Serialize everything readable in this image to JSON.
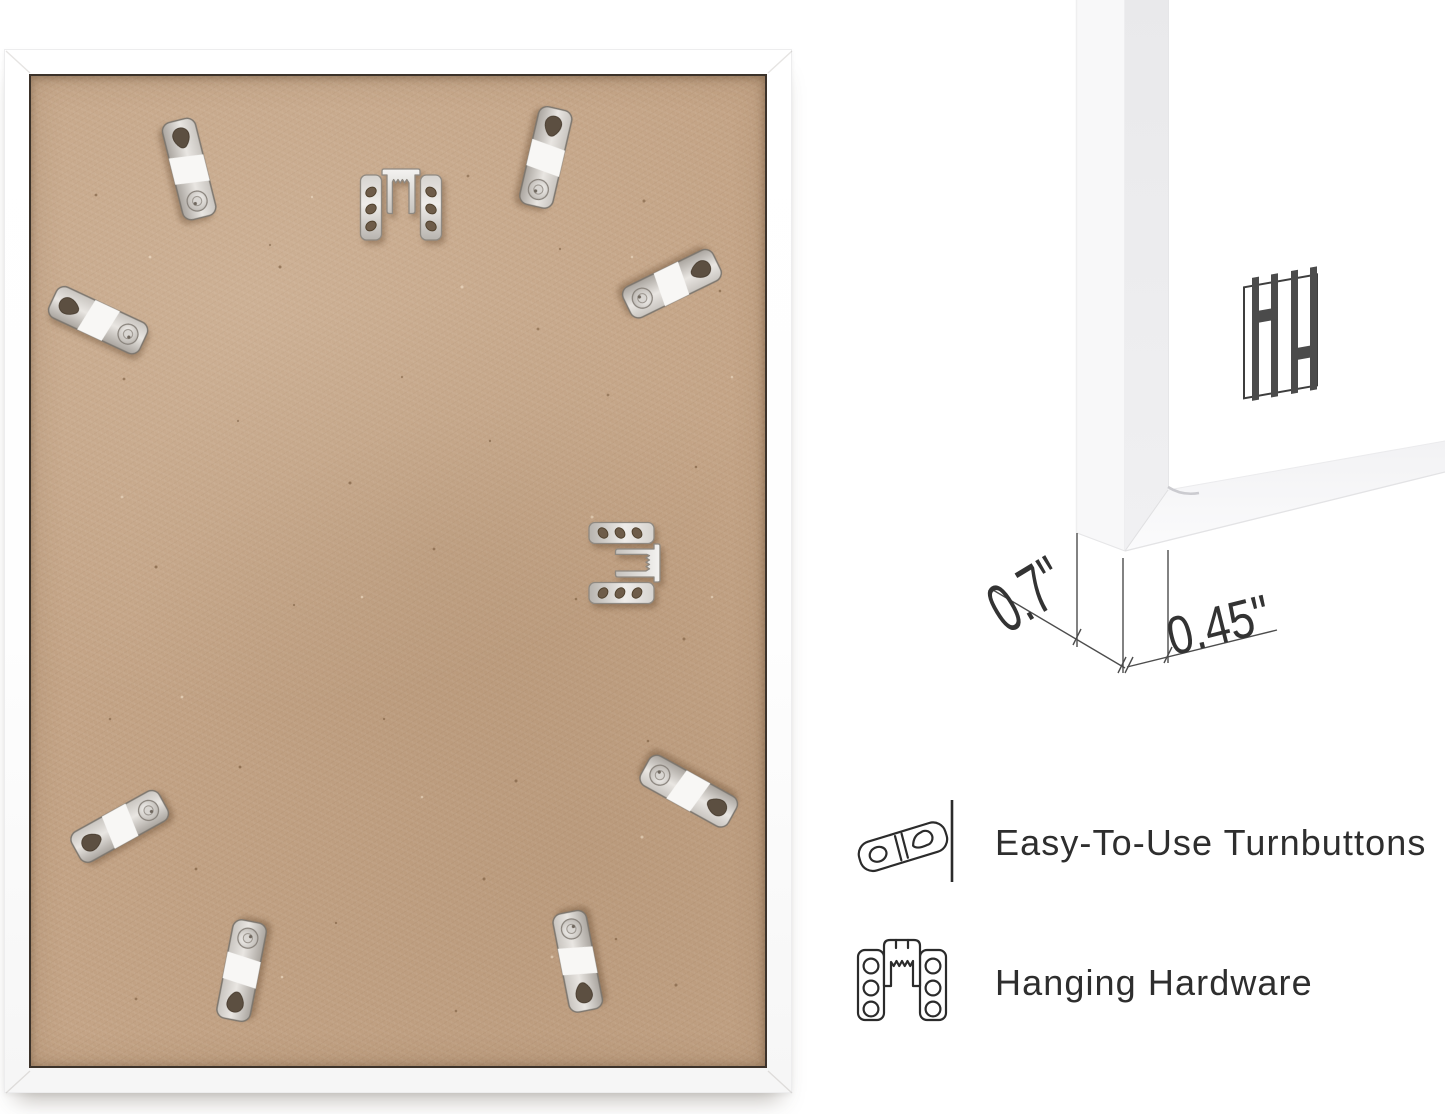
{
  "page": {
    "background": "#ffffff"
  },
  "photo": {
    "subject": "back-of-white-picture-frame",
    "frame_color": "#ffffff",
    "board_color": "#c3a385",
    "turnbutton_count": 8,
    "sawtooth_hanger_count": 2
  },
  "corner_view": {
    "frame_color": "#ffffff",
    "logo_icon": "hh-bars-logo",
    "logo_color": "#474747"
  },
  "dimensions": {
    "depth_label": "0.7\"",
    "face_label": "0.45\""
  },
  "features": [
    {
      "icon": "turnbutton-icon",
      "label": "Easy-To-Use Turnbuttons"
    },
    {
      "icon": "hanging-hardware-icon",
      "label": "Hanging Hardware"
    }
  ],
  "colors": {
    "text": "#2e2e2e",
    "line_art": "#2b2b2b",
    "dimension_lines": "#4d4d4d",
    "metal": "#cfccc8"
  }
}
